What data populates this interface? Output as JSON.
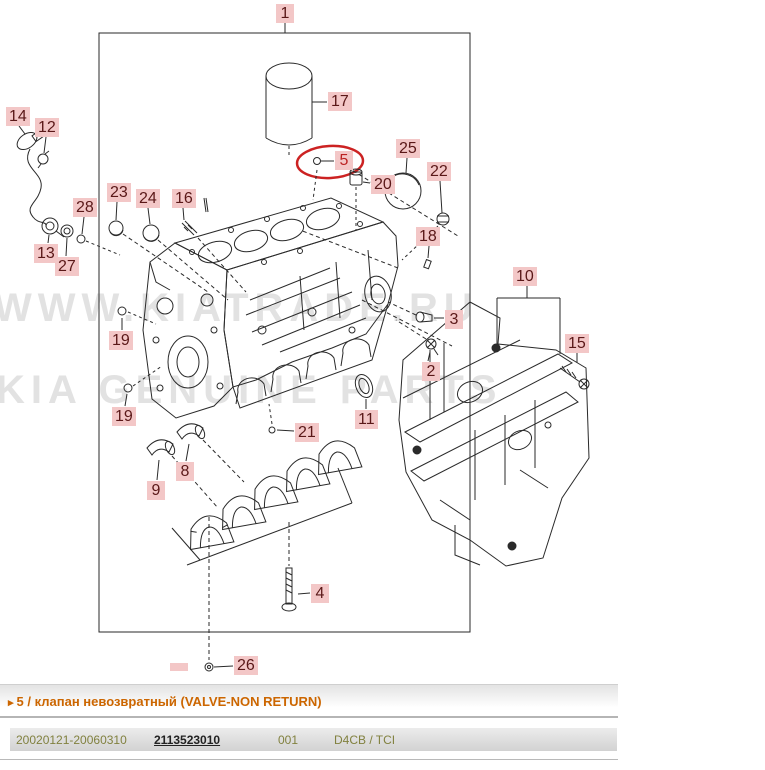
{
  "diagram": {
    "watermark": {
      "line1": "WWW.KIATRADE.RU",
      "line2": "KIA GENUINE PARTS"
    },
    "colors": {
      "label_bg": "#f3c7c7",
      "label_text": "#5a1818",
      "highlight_ellipse": "#cc2222",
      "line": "#2a2a2a"
    },
    "callouts": [
      {
        "label": "1",
        "x": 276,
        "y": 4
      },
      {
        "label": "17",
        "x": 328,
        "y": 92
      },
      {
        "label": "14",
        "x": 6,
        "y": 107
      },
      {
        "label": "12",
        "x": 35,
        "y": 118
      },
      {
        "label": "23",
        "x": 107,
        "y": 183
      },
      {
        "label": "24",
        "x": 136,
        "y": 189
      },
      {
        "label": "16",
        "x": 172,
        "y": 189
      },
      {
        "label": "28",
        "x": 73,
        "y": 198
      },
      {
        "label": "5",
        "x": 335,
        "y": 151,
        "highlight": true
      },
      {
        "label": "25",
        "x": 396,
        "y": 139
      },
      {
        "label": "20",
        "x": 371,
        "y": 175
      },
      {
        "label": "22",
        "x": 427,
        "y": 162
      },
      {
        "label": "18",
        "x": 416,
        "y": 227
      },
      {
        "label": "13",
        "x": 34,
        "y": 244
      },
      {
        "label": "27",
        "x": 55,
        "y": 257
      },
      {
        "label": "10",
        "x": 513,
        "y": 267
      },
      {
        "label": "3",
        "x": 445,
        "y": 310
      },
      {
        "label": "19",
        "x": 109,
        "y": 331
      },
      {
        "label": "15",
        "x": 565,
        "y": 334
      },
      {
        "label": "2",
        "x": 422,
        "y": 362
      },
      {
        "label": "19",
        "x": 112,
        "y": 407
      },
      {
        "label": "11",
        "x": 355,
        "y": 410
      },
      {
        "label": "21",
        "x": 295,
        "y": 423
      },
      {
        "label": "8",
        "x": 176,
        "y": 462
      },
      {
        "label": "9",
        "x": 147,
        "y": 481
      },
      {
        "label": "4",
        "x": 311,
        "y": 584
      },
      {
        "label": "26",
        "x": 234,
        "y": 656
      }
    ]
  },
  "footer": {
    "arrow": "▸",
    "selected_part_title": "5 / клапан невозвратный (VALVE-NON RETURN)",
    "row": {
      "date_range": "20020121-20060310",
      "part_number": "2113523010",
      "qty": "001",
      "model": "D4CB / TCI"
    }
  }
}
